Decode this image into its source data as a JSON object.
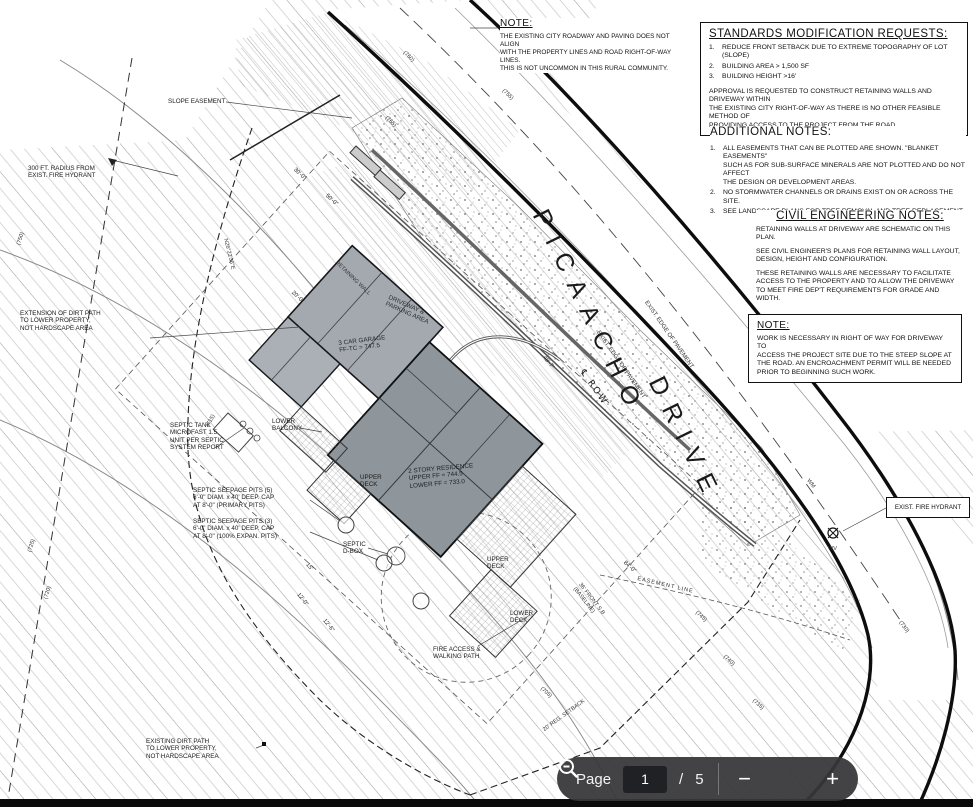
{
  "toolbar": {
    "page_label": "Page",
    "current_page": "1",
    "page_divider": "/",
    "total_pages": "5",
    "zoom_out_label": "−",
    "zoom_in_label": "+",
    "bar_color": "#37373a",
    "text_color": "#f1f3f4"
  },
  "notes": {
    "top_note": {
      "title": "NOTE:",
      "body": "THE EXISTING CITY ROADWAY AND PAVING DOES NOT ALIGN\nWITH THE PROPERTY LINES AND ROAD RIGHT-OF-WAY LINES.\nTHIS IS NOT UNCOMMON IN THIS RURAL COMMUNITY."
    },
    "standards": {
      "title": "STANDARDS MODIFICATION REQUESTS:",
      "items": [
        "REDUCE FRONT SETBACK DUE TO EXTREME TOPOGRAPHY OF LOT (SLOPE)",
        "BUILDING AREA > 1,500 SF",
        "BUILDING HEIGHT >16'"
      ],
      "numbers": [
        "1.",
        "2.",
        "3."
      ],
      "paragraph": "APPROVAL IS REQUESTED TO CONSTRUCT RETAINING WALLS AND DRIVEWAY WITHIN\nTHE EXISTING CITY RIGHT-OF-WAY AS THERE IS NO OTHER FEASIBLE METHOD OF\nPROVIDING ACCESS TO THE PROJECT FROM THE ROAD."
    },
    "additional": {
      "title": "ADDITIONAL NOTES:",
      "numbers": [
        "1.",
        "2.",
        "3."
      ],
      "items": [
        "ALL EASEMENTS THAT CAN BE PLOTTED ARE SHOWN. \"BLANKET EASEMENTS\"\nSUCH AS FOR SUB-SURFACE MINERALS ARE NOT PLOTTED AND DO NOT AFFECT\nTHE DESIGN OR DEVELOPMENT AREAS.",
        "NO STORMWATER CHANNELS OR DRAINS EXIST ON OR ACROSS THE SITE.",
        "SEE LANDSCAPE PLANS FOR TREE REMOVAL AND TREE REPLACEMENT."
      ]
    },
    "civil": {
      "title": "CIVIL ENGINEERING NOTES:",
      "paragraphs": [
        "RETAINING WALLS AT DRIVEWAY ARE SCHEMATIC ON THIS PLAN.",
        "SEE CIVIL ENGINEER'S PLANS FOR RETAINING WALL LAYOUT,\nDESIGN, HEIGHT AND CONFIGURATION.",
        "THESE RETAINING WALLS ARE NECESSARY TO FACILITATE\nACCESS TO THE PROPERTY AND TO ALLOW THE DRIVEWAY\nTO MEET FIRE DEP'T REQUIREMENTS FOR GRADE AND WIDTH."
      ]
    },
    "row_note": {
      "title": "NOTE:",
      "body": "WORK IS NECESSARY IN RIGHT OF WAY FOR DRIVEWAY TO\nACCESS THE PROJECT SITE DUE TO THE STEEP SLOPE AT\nTHE ROAD. AN ENCROACHMENT PERMIT WILL BE NEEDED\nPRIOR TO BEGINNING SUCH WORK."
    }
  },
  "plan": {
    "labels": {
      "slope_easement": "SLOPE EASEMENT",
      "fire_hydrant_radius": "300 FT. RADIUS FROM\nEXIST. FIRE HYDRANT",
      "extension_dirt_path": "EXTENSION OF DIRT PATH\nTO LOWER PROPERTY,\nNOT HARDSCAPE AREA",
      "septic_tank": "SEPTIC TANK\nMICROFAST 1.5\nUNIT PER SEPTIC\nSYSTEM REPORT",
      "lower_balcony": "LOWER\nBALCONY",
      "garage": "3 CAR GARAGE\nFF-TC = 747.5",
      "residence": "2 STORY RESIDENCE\nUPPER FF = 744.5\nLOWER FF = 733.0",
      "upper_deck_west": "UPPER\nDECK",
      "upper_deck_east": "UPPER\nDECK",
      "lower_deck": "LOWER\nDECK",
      "septic_pits_primary": "SEPTIC SEEPAGE PITS (5)\n6'-0\" DIAM. x 40' DEEP. CAP\nAT 8'-0\" (PRIMARY PITS)",
      "septic_pits_expansion": "SEPTIC SEEPAGE PITS (3)\n6'-0\" DIAM. x 40' DEEP. CAP\nAT 8'-0\" (100% EXPAN. PITS)",
      "septic_dbox": "SEPTIC\nD-BOX",
      "fire_access": "FIRE ACCESS &\nWALKING PATH",
      "existing_dirt_path": "EXISTING DIRT PATH\nTO LOWER PROPERTY,\nNOT HARDSCAPE AREA",
      "driveway_parking": "DRIVEWAY &\nPARKING AREA",
      "retaining_wall": "RETAINING WALL",
      "edge_pavement": "EXIST. EDGE OF PAVEMENT",
      "cl_row": "℄ ROW",
      "wm": "WM",
      "wv": "WV",
      "exist_fire_hydrant": "EXIST. FIRE HYDRANT",
      "front_setback": "36' FRONT S.B\n(BASELINE)",
      "reg_setback": "20' REG. SETBACK",
      "easement_line": "EASEMENT LINE",
      "bearing_west": "N26°22'36\"E"
    },
    "street": {
      "name_1": "PICAACHO",
      "name_2": "DRIVE"
    },
    "dims": {
      "d84": "84'-0\"",
      "d50": "50'-0\"",
      "d30": "30'-0\"",
      "d20": "20'-0\"",
      "d12": "12'-0\"",
      "d12_6": "12'-6\"",
      "d48_7": "48'-7\"",
      "d15": "15'"
    },
    "contours": [
      "(765)",
      "(760)",
      "(755)",
      "(750)",
      "(745)",
      "(740)",
      "(735)",
      "(730)",
      "(725)",
      "(720)",
      "(715)",
      "(705)"
    ]
  }
}
